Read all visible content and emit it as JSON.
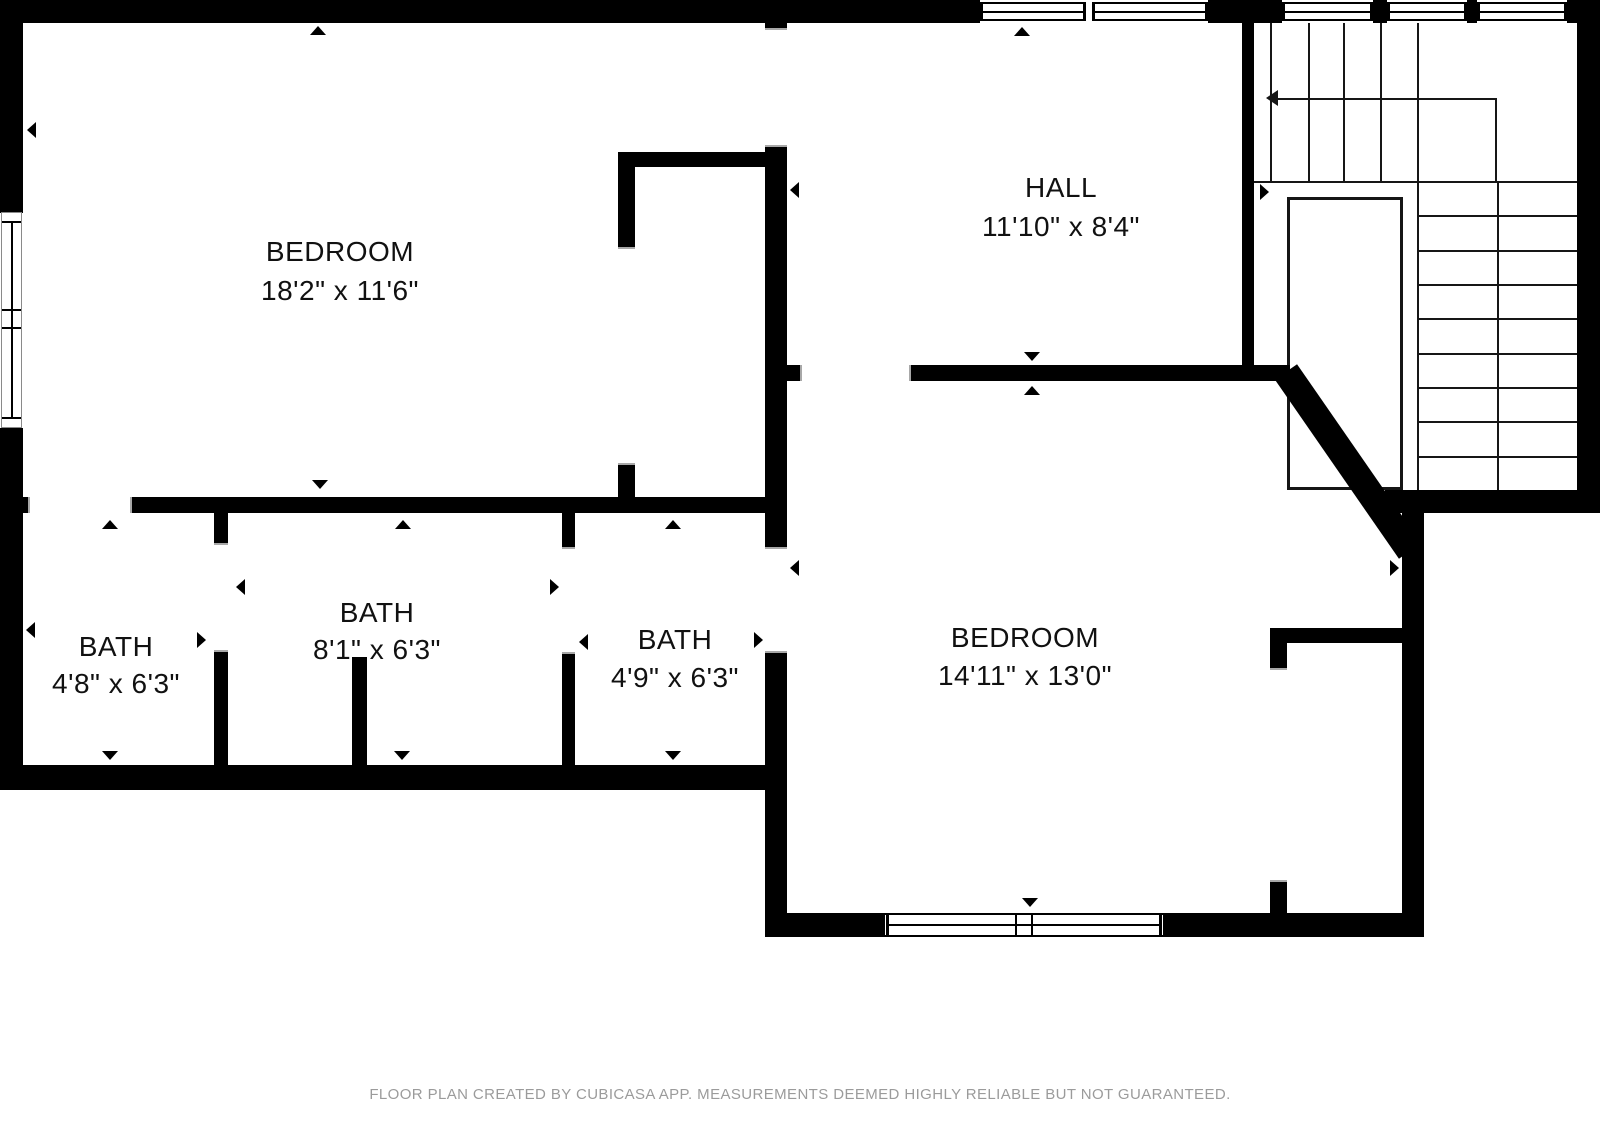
{
  "title": "Floor plan",
  "footer": {
    "text": "FLOOR PLAN CREATED BY CUBICASA APP. MEASUREMENTS DEEMED HIGHLY RELIABLE BUT NOT GUARANTEED."
  },
  "colors": {
    "wall": "#000000",
    "background": "#ffffff",
    "stair_line": "#161616",
    "door_jamb": "#a8a8a8",
    "footer_text": "#9b9b9b",
    "label_text": "#111111"
  },
  "rooms": [
    {
      "id": "bedroom-1",
      "name": "BEDROOM",
      "dims": "18'2\" x 11'6\"",
      "cx": 340,
      "cy": 252,
      "cy2": 291
    },
    {
      "id": "hall",
      "name": "HALL",
      "dims": "11'10\" x 8'4\"",
      "cx": 1061,
      "cy": 188,
      "cy2": 227
    },
    {
      "id": "bath-1",
      "name": "BATH",
      "dims": "4'8\" x 6'3\"",
      "cx": 116,
      "cy": 647,
      "cy2": 684
    },
    {
      "id": "bath-2",
      "name": "BATH",
      "dims": "8'1\" x 6'3\"",
      "cx": 377,
      "cy": 613,
      "cy2": 650
    },
    {
      "id": "bath-3",
      "name": "BATH",
      "dims": "4'9\" x 6'3\"",
      "cx": 675,
      "cy": 640,
      "cy2": 678
    },
    {
      "id": "bedroom-2",
      "name": "BEDROOM",
      "dims": "14'11\" x 13'0\"",
      "cx": 1025,
      "cy": 638,
      "cy2": 676
    }
  ],
  "geometry": {
    "walls": [
      [
        0,
        0,
        980,
        23
      ],
      [
        1208,
        0,
        74,
        23
      ],
      [
        1373,
        0,
        14,
        23
      ],
      [
        1467,
        0,
        10,
        23
      ],
      [
        1567,
        0,
        33,
        23
      ],
      [
        1577,
        0,
        23,
        513
      ],
      [
        0,
        0,
        23,
        213
      ],
      [
        0,
        428,
        23,
        362
      ],
      [
        0,
        497,
        28,
        16
      ],
      [
        132,
        497,
        655,
        16
      ],
      [
        0,
        765,
        787,
        25
      ],
      [
        214,
        513,
        14,
        30
      ],
      [
        214,
        652,
        14,
        113
      ],
      [
        562,
        513,
        13,
        34
      ],
      [
        562,
        654,
        13,
        111
      ],
      [
        352,
        657,
        15,
        108
      ],
      [
        765,
        23,
        22,
        5
      ],
      [
        765,
        147,
        22,
        400
      ],
      [
        765,
        653,
        22,
        284
      ],
      [
        618,
        152,
        169,
        15
      ],
      [
        618,
        152,
        17,
        95
      ],
      [
        618,
        465,
        17,
        48
      ],
      [
        787,
        365,
        13,
        16
      ],
      [
        911,
        365,
        379,
        16
      ],
      [
        1242,
        23,
        12,
        342
      ],
      [
        1385,
        490,
        215,
        23
      ],
      [
        1402,
        510,
        22,
        427
      ],
      [
        765,
        913,
        118,
        24
      ],
      [
        1165,
        913,
        259,
        24
      ],
      [
        1270,
        628,
        133,
        15
      ],
      [
        1270,
        628,
        17,
        40
      ],
      [
        1270,
        882,
        17,
        31
      ]
    ],
    "diagonal": {
      "cx": 1348,
      "cy": 461,
      "len": 218,
      "thick": 27,
      "angle": 55.3
    },
    "stairs": {
      "vlines": [
        [
          1270,
          23,
          181
        ],
        [
          1308,
          23,
          181
        ],
        [
          1343,
          23,
          181
        ],
        [
          1380,
          23,
          181
        ],
        [
          1417,
          23,
          490
        ],
        [
          1497,
          181,
          490
        ]
      ],
      "hlines": [
        [
          1254,
          1577,
          181
        ],
        [
          1417,
          1577,
          215
        ],
        [
          1417,
          1577,
          250
        ],
        [
          1417,
          1577,
          284
        ],
        [
          1417,
          1577,
          318
        ],
        [
          1417,
          1577,
          353
        ],
        [
          1417,
          1577,
          387
        ],
        [
          1417,
          1577,
          421
        ],
        [
          1417,
          1577,
          456
        ]
      ],
      "void": {
        "x": 1287,
        "y": 197,
        "w": 116,
        "h": 293
      },
      "arrow": {
        "hx1": 1278,
        "hx2": 1497,
        "hy": 98,
        "vx": 1495,
        "vy1": 98,
        "vy2": 181,
        "head_x": 1266,
        "head_y": 98
      }
    },
    "windows": {
      "top_panes": [
        [
          980,
          1086
        ],
        [
          1092,
          1208
        ],
        [
          1282,
          1373
        ],
        [
          1387,
          1467
        ],
        [
          1477,
          1567
        ]
      ],
      "top_y": 2,
      "top_h": 19,
      "bottom": {
        "x": 883,
        "y": 913,
        "w": 282,
        "h": 24,
        "mullions": [
          1015,
          1031
        ],
        "frames": [
          886,
          1159
        ]
      },
      "left": {
        "x": 1,
        "y": 212,
        "w": 21,
        "h": 216,
        "hlines": [
          221,
          309,
          327,
          417
        ],
        "center_x": 10
      }
    },
    "doors": [
      {
        "x": 28,
        "y": 497,
        "w": 104,
        "h": 16,
        "o": "h"
      },
      {
        "x": 214,
        "y": 543,
        "w": 14,
        "h": 109,
        "o": "v"
      },
      {
        "x": 562,
        "y": 547,
        "w": 13,
        "h": 107,
        "o": "v"
      },
      {
        "x": 765,
        "y": 547,
        "w": 22,
        "h": 106,
        "o": "v"
      },
      {
        "x": 765,
        "y": 28,
        "w": 22,
        "h": 119,
        "o": "v"
      },
      {
        "x": 618,
        "y": 247,
        "w": 17,
        "h": 218,
        "o": "v"
      },
      {
        "x": 800,
        "y": 365,
        "w": 111,
        "h": 16,
        "o": "h"
      },
      {
        "x": 1270,
        "y": 668,
        "w": 17,
        "h": 214,
        "o": "v"
      }
    ],
    "markers": [
      {
        "x": 318,
        "y": 26,
        "dir": "up"
      },
      {
        "x": 1022,
        "y": 27,
        "dir": "up"
      },
      {
        "x": 110,
        "y": 520,
        "dir": "up"
      },
      {
        "x": 403,
        "y": 520,
        "dir": "up"
      },
      {
        "x": 673,
        "y": 520,
        "dir": "up"
      },
      {
        "x": 1032,
        "y": 386,
        "dir": "up"
      },
      {
        "x": 320,
        "y": 489,
        "dir": "down"
      },
      {
        "x": 1032,
        "y": 361,
        "dir": "down"
      },
      {
        "x": 110,
        "y": 760,
        "dir": "down"
      },
      {
        "x": 402,
        "y": 760,
        "dir": "down"
      },
      {
        "x": 673,
        "y": 760,
        "dir": "down"
      },
      {
        "x": 1030,
        "y": 907,
        "dir": "down"
      },
      {
        "x": 27,
        "y": 130,
        "dir": "left"
      },
      {
        "x": 26,
        "y": 630,
        "dir": "left"
      },
      {
        "x": 236,
        "y": 587,
        "dir": "left"
      },
      {
        "x": 579,
        "y": 642,
        "dir": "left"
      },
      {
        "x": 790,
        "y": 568,
        "dir": "left"
      },
      {
        "x": 790,
        "y": 190,
        "dir": "left"
      },
      {
        "x": 206,
        "y": 640,
        "dir": "right"
      },
      {
        "x": 559,
        "y": 587,
        "dir": "right"
      },
      {
        "x": 763,
        "y": 640,
        "dir": "right"
      },
      {
        "x": 1269,
        "y": 192,
        "dir": "right"
      },
      {
        "x": 1399,
        "y": 568,
        "dir": "right"
      }
    ]
  }
}
